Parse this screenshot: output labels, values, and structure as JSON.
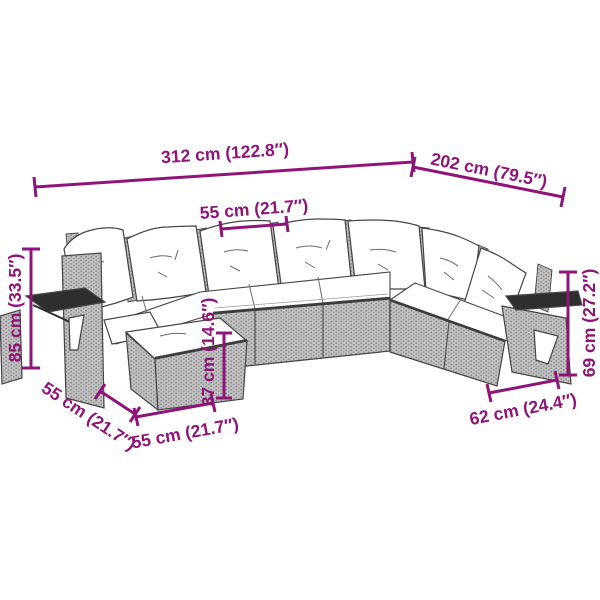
{
  "palette": {
    "dimension_color": "#8E1577",
    "line_color": "#454545",
    "rattan_base": "#c3c3c3",
    "rattan_dot": "#828282",
    "cushion": "#ffffff",
    "tray": "#2e2e2e",
    "background": "#ffffff"
  },
  "dimensions": {
    "total_width": {
      "label": "312 cm (122.8″)"
    },
    "side_length": {
      "label": "202 cm (79.5″)"
    },
    "seat_width": {
      "label": "55 cm (21.7″)"
    },
    "total_height": {
      "label": "85 cm (33.5″)"
    },
    "seat_height": {
      "label": "37 cm (14.6″)"
    },
    "stool_depth": {
      "label": "55 cm (21.7″)"
    },
    "stool_width": {
      "label": "55 cm (21.7″)"
    },
    "end_width": {
      "label": "62 cm (24.4″)"
    },
    "back_height": {
      "label": "69 cm (27.2″)"
    }
  }
}
